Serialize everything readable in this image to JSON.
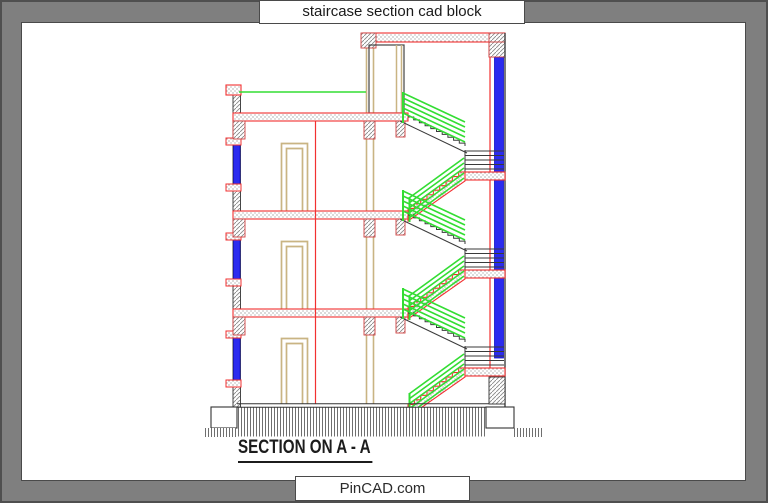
{
  "window": {
    "title": "staircase section cad block"
  },
  "drawing": {
    "caption": "SECTION ON A - A",
    "type": "architectural-section",
    "storeys": 3,
    "elements": [
      "floor-slabs",
      "half-landings",
      "stair-flights",
      "handrails",
      "windows",
      "door-frames",
      "foundations",
      "ground-hatch"
    ]
  },
  "footer": {
    "watermark": "PinCAD.com"
  },
  "palette": {
    "frame_gray": "#7f7f7f",
    "border_dark": "#4a4a4a",
    "line_red": "#f23030",
    "rail_green": "#33dd33",
    "wall_blue": "#2b2bef",
    "frame_tan": "#c9b483",
    "line_dark": "#333333"
  }
}
